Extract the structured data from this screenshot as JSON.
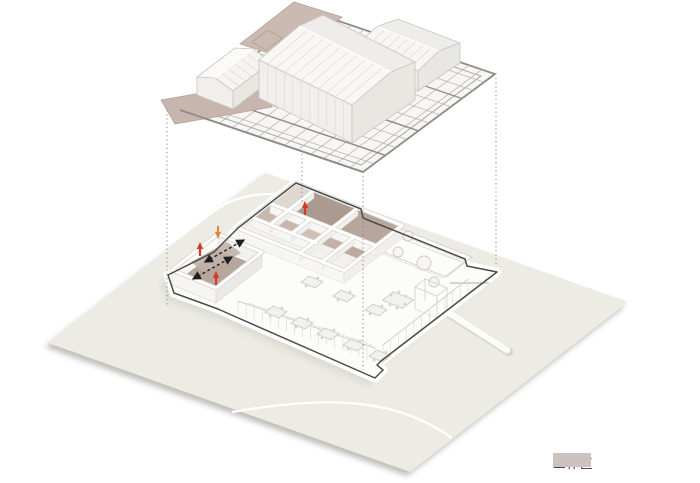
{
  "legend": {
    "items": [
      {
        "label": "工作区",
        "swatch_color": "#cdc2be"
      }
    ]
  },
  "colors": {
    "ground": "#ecebe4",
    "work_area": "#c7b6ae",
    "work_area_top": "#cbbab2",
    "room_floor": "#ab9a90",
    "plate_outline": "#4c4b45",
    "deck_beam": "#8d8c87",
    "red_arrow": "#d6392a",
    "orange_arrow": "#e8823f",
    "circulation_arrow": "#1f1f1f",
    "site_path": "#ffffff"
  },
  "annotations": {
    "red_up_arrows": 3,
    "orange_arrows": 1,
    "circulation_dashed_arrows": 2,
    "projection_lines": 4,
    "roof_volumes": 3,
    "work_area_panels": 2
  }
}
